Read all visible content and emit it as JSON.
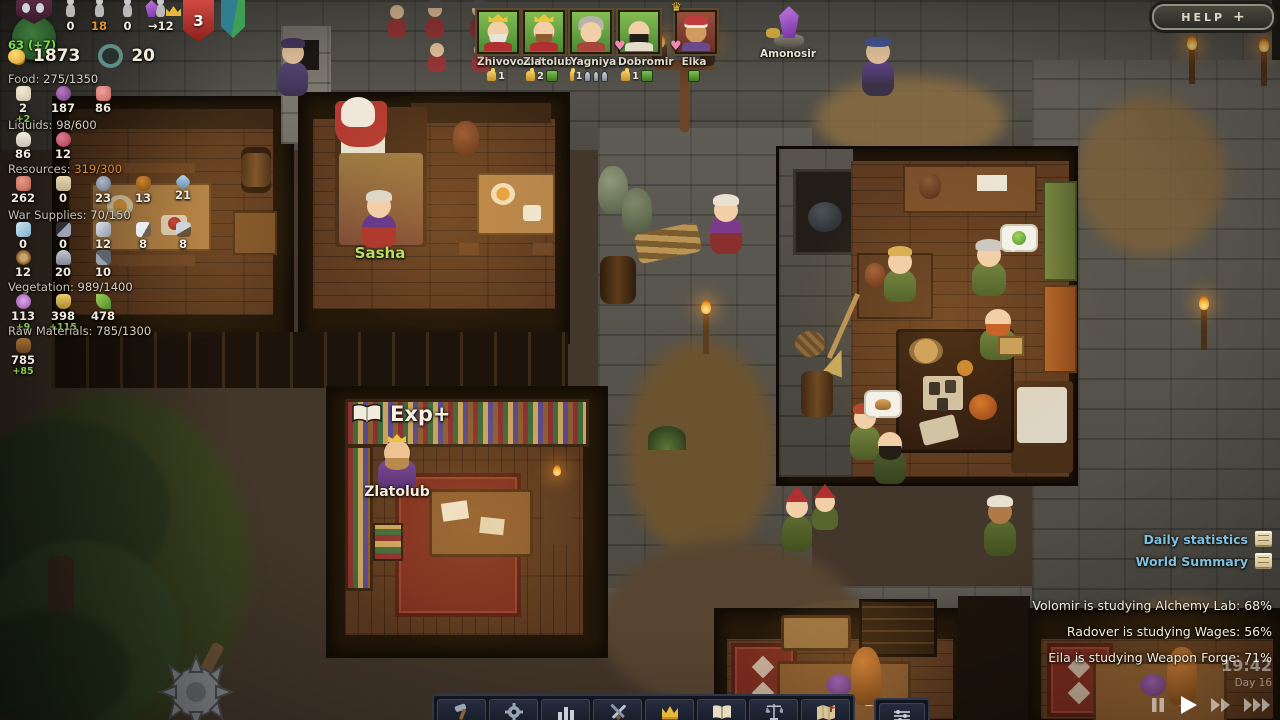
{
  "hud": {
    "crest_value": "63 (+7)",
    "population": [
      {
        "icon": "villager-icon",
        "value": "0"
      },
      {
        "icon": "villager-icon",
        "value": "18"
      },
      {
        "icon": "villager-icon",
        "value": "0"
      },
      {
        "icon": "villager-arrival-icon",
        "value": "→12"
      }
    ],
    "threat_badge": "3",
    "gold": "1873",
    "tools": "20",
    "sections": [
      {
        "label": "Food:",
        "value": "275/1350",
        "items": [
          {
            "icon": "flour-icon",
            "value": "2",
            "delta": "+2"
          },
          {
            "icon": "plums-icon",
            "value": "187",
            "delta": ""
          },
          {
            "icon": "meat-icon",
            "value": "86",
            "delta": ""
          }
        ]
      },
      {
        "label": "Liquids:",
        "value": "98/600",
        "items": [
          {
            "icon": "milk-icon",
            "value": "86",
            "delta": ""
          },
          {
            "icon": "berries-icon",
            "value": "12",
            "delta": ""
          }
        ]
      },
      {
        "label": "Resources:",
        "value": "319/300",
        "items": [
          {
            "icon": "clay-icon",
            "value": "262",
            "delta": ""
          },
          {
            "icon": "paper-icon",
            "value": "0",
            "delta": ""
          },
          {
            "icon": "ore-icon",
            "value": "23",
            "delta": ""
          },
          {
            "icon": "honey-icon",
            "value": "13",
            "delta": ""
          },
          {
            "icon": "gems-icon",
            "value": "21",
            "delta": ""
          }
        ]
      },
      {
        "label": "War Supplies:",
        "value": "70/150",
        "items": [
          {
            "icon": "ice-icon",
            "value": "0",
            "delta": ""
          },
          {
            "icon": "sword-icon",
            "value": "0",
            "delta": ""
          },
          {
            "icon": "blade-icon",
            "value": "12",
            "delta": ""
          },
          {
            "icon": "knife-icon",
            "value": "8",
            "delta": ""
          },
          {
            "icon": "spear-icon",
            "value": "8",
            "delta": ""
          }
        ],
        "items2": [
          {
            "icon": "shield-icon",
            "value": "12",
            "delta": ""
          },
          {
            "icon": "helmet-icon",
            "value": "20",
            "delta": ""
          },
          {
            "icon": "tools-icon",
            "value": "10",
            "delta": ""
          }
        ]
      },
      {
        "label": "Vegetation:",
        "value": "989/1400",
        "items": [
          {
            "icon": "flower-icon",
            "value": "113",
            "delta": "+9"
          },
          {
            "icon": "wheat-icon",
            "value": "398",
            "delta": "+115"
          },
          {
            "icon": "leaf-icon",
            "value": "478",
            "delta": ""
          }
        ]
      },
      {
        "label": "Raw Materials:",
        "value": "785/1300",
        "items": [
          {
            "icon": "log-icon",
            "value": "785",
            "delta": "+85"
          }
        ]
      }
    ]
  },
  "portraits": [
    {
      "name": "Zhivovolod",
      "thumb": "1"
    },
    {
      "name": "Zlatolub",
      "thumb": "2"
    },
    {
      "name": "Yagniya",
      "thumb": "1"
    },
    {
      "name": "Dobromir",
      "thumb": "1"
    },
    {
      "name": "Elka",
      "thumb": ""
    }
  ],
  "relic": {
    "label": "Amonosir"
  },
  "help_button": {
    "label": "HELP",
    "plus": "+"
  },
  "links": [
    {
      "label": "Daily statistics",
      "icon": "report-scroll-icon"
    },
    {
      "label": "World Summary",
      "icon": "report-scroll-icon"
    }
  ],
  "messages": [
    "Volomir is studying Alchemy Lab: 68%",
    "Radover is studying Wages: 56%",
    "Eila is studying Weapon Forge: 71%"
  ],
  "clock": {
    "time": "19:42",
    "day": "Day 16"
  },
  "world_labels": {
    "sasha": "Sasha",
    "exp": "Exp+",
    "zlatolub": "Zlatolub"
  },
  "toolbar": {
    "buttons": [
      {
        "icon": "build-hammer-icon"
      },
      {
        "icon": "production-gear-icon"
      },
      {
        "icon": "statistics-icon"
      },
      {
        "icon": "military-swords-icon"
      },
      {
        "icon": "rulers-crown-icon"
      },
      {
        "icon": "knowledge-book-icon"
      },
      {
        "icon": "laws-scales-icon"
      },
      {
        "icon": "world-map-icon"
      }
    ],
    "extra_button": {
      "icon": "options-sliders-icon"
    }
  },
  "playback": {
    "buttons": [
      {
        "icon": "pause-icon"
      },
      {
        "icon": "play-icon"
      },
      {
        "icon": "fast-forward-icon"
      },
      {
        "icon": "fastest-forward-icon"
      }
    ]
  },
  "colors": {
    "accent_green_label": "#b8df63",
    "link_blue": "#7fc0dc",
    "over_capacity_orange": "#d98a3a",
    "threat_red": "#b03030"
  }
}
